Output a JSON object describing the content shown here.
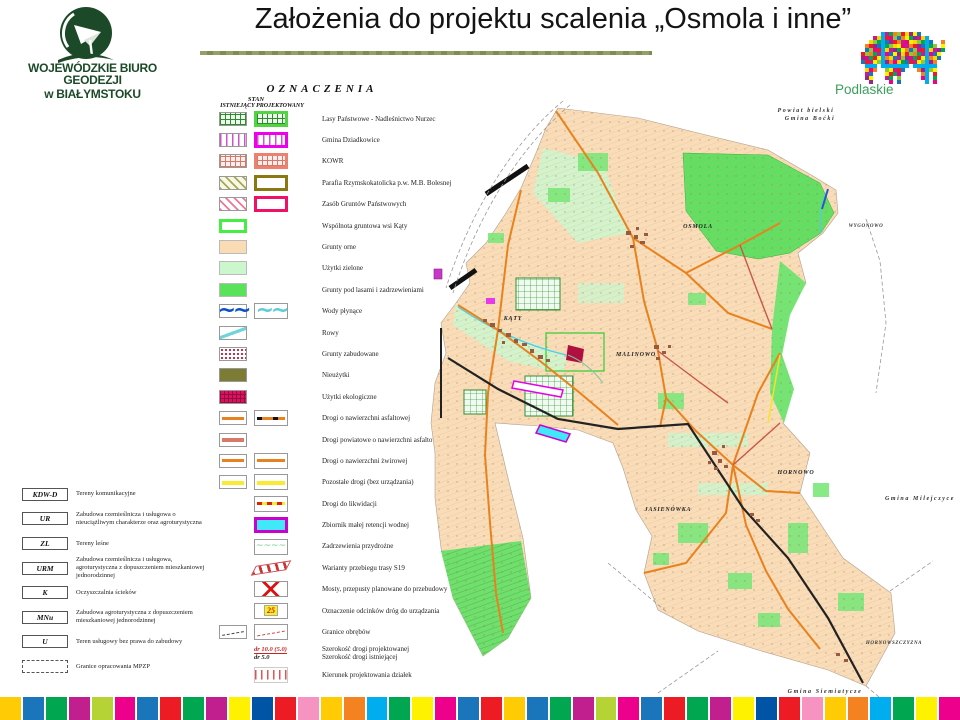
{
  "slide": {
    "title": "Założenia do projektu scalenia „Osmola i inne”"
  },
  "logo": {
    "line1": "WOJEWÓDZKIE BIURO GEODEZJI",
    "line2": "w BIAŁYMSTOKU",
    "color": "#1c4a28"
  },
  "podlaskie": {
    "label": "Podlaskie",
    "label_color": "#3aa05a",
    "palette": [
      "#ed1c24",
      "#1b75bb",
      "#00a650",
      "#ffd400",
      "#ec008c",
      "#f58220",
      "#92278f",
      "#00aeef",
      "#8dc63f",
      "#fff200",
      "#c21f8e"
    ],
    "bitmap": [
      "......XXXXXXXXXX........",
      "....XXXXXXXXXXXXXX......",
      "...XXXXXXXXXXXXXXXX..X..",
      "..XXXXXXXXXXXXXXXXXX.X..",
      "..XXXXXXXXXXXXXXXXXXXX..",
      ".XXXXXXXXXXXXXXXXXXXX...",
      ".XXXXXXXXXXXXXXXXXXXX...",
      ".XXXXXXXXXXXXXXXXXXX....",
      "..XXX.XXXXXXX.XXXXXX....",
      "..XXX..XXXXX...XXXXX....",
      "..XX...XXXX.....XX.X....",
      "..XX...XX.X.....XX.X....",
      "...X....X.X......X.X...."
    ]
  },
  "legend": {
    "heading": "OZNACZENIA",
    "stan": "STAN",
    "col1": "ISTNIEJĄCY",
    "col2": "PROJEKTOWANY",
    "items": [
      {
        "sw1": "grid-green",
        "sw2": "grid-green-b",
        "label": "Lasy Państwowe - Nadleśnictwo Nurzec"
      },
      {
        "sw1": "stripes-magenta",
        "sw2": "stripes-magenta-b",
        "label": "Gmina Dziadkowice"
      },
      {
        "sw1": "grid-salmon",
        "sw2": "grid-salmon-b",
        "label": "KOWR"
      },
      {
        "sw1": "hatch-olive",
        "sw2": "border-olive",
        "label": "Parafia Rzymskokatolicka p.w. M.B. Bolesnej"
      },
      {
        "sw1": "hatch-pink",
        "sw2": "border-pink",
        "label": "Zasób Gruntów Państwowych"
      },
      {
        "sw1": "border-green",
        "label": "Wspólnota gruntowa wsi Kąty"
      },
      {
        "sw1": "fill-peach",
        "label": "Grunty orne"
      },
      {
        "sw1": "fill-lightgreen",
        "label": "Użytki zielone"
      },
      {
        "sw1": "fill-green",
        "label": "Grunty pod lasami i zadrzewieniami"
      },
      {
        "sw1": "wave-blue",
        "sw2": "wave-cyan",
        "label": "Wody płynące"
      },
      {
        "sw1": "curve-cyan",
        "label": "Rowy"
      },
      {
        "sw1": "dots-darkred",
        "label": "Grunty zabudowane"
      },
      {
        "sw1": "fill-olive",
        "label": "Nieużytki"
      },
      {
        "sw1": "grid-crimson",
        "label": "Użytki ekologiczne"
      },
      {
        "sw1": "road-asphalt",
        "sw2": "road-asphalt-p",
        "label": "Drogi o nawierzchni asfaltowej"
      },
      {
        "sw1": "road-powiat",
        "label": "Drogi powiatowe o nawierzchni asfaltowej"
      },
      {
        "sw1": "road-gravel",
        "sw2": "road-gravel",
        "label": "Drogi o nawierzchni żwirowej"
      },
      {
        "sw1": "road-other",
        "sw2": "road-other",
        "label": "Pozostałe drogi (bez urządzania)"
      },
      {
        "sw2": "road-liq",
        "label": "Drogi do likwidacji"
      },
      {
        "sw2": "reservoir",
        "label": "Zbiornik małej retencji wodnej"
      },
      {
        "sw2": "wave-green",
        "label": "Zadrzewienia przydrożne"
      },
      {
        "sw2": "band-s19",
        "label": "Warianty przebiegu trasy S19"
      },
      {
        "sw2": "bridge-x",
        "label": "Mosty, przepusty planowane do przebudowy"
      },
      {
        "sw2": "marker25",
        "glyph": "25",
        "label": "Oznaczenie odcinków dróg do urządzania"
      },
      {
        "sw1": "boundary-dash",
        "sw2": "boundary-dash-r",
        "label": "Granice obrębów"
      },
      {
        "sw2": "width-text",
        "glyph": "dr 10.0 (5.0)",
        "glyph2": "dr 5.0",
        "label": "Szerokość drogi projektowanej",
        "label2": "Szerokość drogi istniejącej"
      },
      {
        "sw2": "ticks-red",
        "label": "Kierunek projektowania działek"
      }
    ],
    "zones": [
      {
        "code": "KDW-D",
        "desc": "Tereny komunikacyjne"
      },
      {
        "code": "UR",
        "desc": "Zabudowa rzemieślnicza i usługowa o nieuciążliwym charakterze oraz agroturystyczna"
      },
      {
        "code": "ZL",
        "desc": "Tereny leśne"
      },
      {
        "code": "URM",
        "desc": "Zabudowa rzemieślnicza i usługowa, agroturystyczna z dopuszczeniem mieszkaniowej jednorodzinnej"
      },
      {
        "code": "K",
        "desc": "Oczyszczalnia ścieków"
      },
      {
        "code": "MNu",
        "desc": "Zabudowa agroturystyczna z dopuszczeniem mieszkaniowej jednorodzinnej"
      },
      {
        "code": "U",
        "desc": "Teren usługowy bez prawa do zabudowy"
      },
      {
        "code": "",
        "box": "dashed",
        "desc": "Granice opracowania MPZP"
      }
    ]
  },
  "map": {
    "labels": {
      "powiat": "Powiat bielski",
      "bocki": "Gmina Boćki",
      "wygonowo": "WYGONOWO",
      "osmola": "OSMOLA",
      "katy": "KĄTY",
      "malinowo": "MALINOWO",
      "jasienowka": "JASIENÓWKA",
      "hornowo": "HORNOWO",
      "milejczyce": "Gmina Milejczyce",
      "hornowszczyzna": "HORNOWSZCZYZNA",
      "siemiatycze": "Gmina Siemiatycze"
    }
  },
  "footer": {
    "colors": [
      "#ffcb05",
      "#1b75bb",
      "#00a650",
      "#c21f8e",
      "#b5d334",
      "#ec008c",
      "#1b75bb",
      "#ed1c24",
      "#00a650",
      "#c21f8e",
      "#fff200",
      "#0054a6",
      "#ed1c24",
      "#f693c0",
      "#ffcb05",
      "#f58220",
      "#00aeef",
      "#00a650",
      "#fff200",
      "#ec008c",
      "#1b75bb",
      "#ed1c24",
      "#ffcb05",
      "#1b75bb",
      "#00a650",
      "#c21f8e",
      "#b5d334",
      "#ec008c",
      "#1b75bb",
      "#ed1c24",
      "#00a650",
      "#c21f8e",
      "#fff200",
      "#0054a6",
      "#ed1c24",
      "#f693c0",
      "#ffcb05",
      "#f58220",
      "#00aeef",
      "#00a650",
      "#fff200",
      "#ec008c"
    ]
  }
}
